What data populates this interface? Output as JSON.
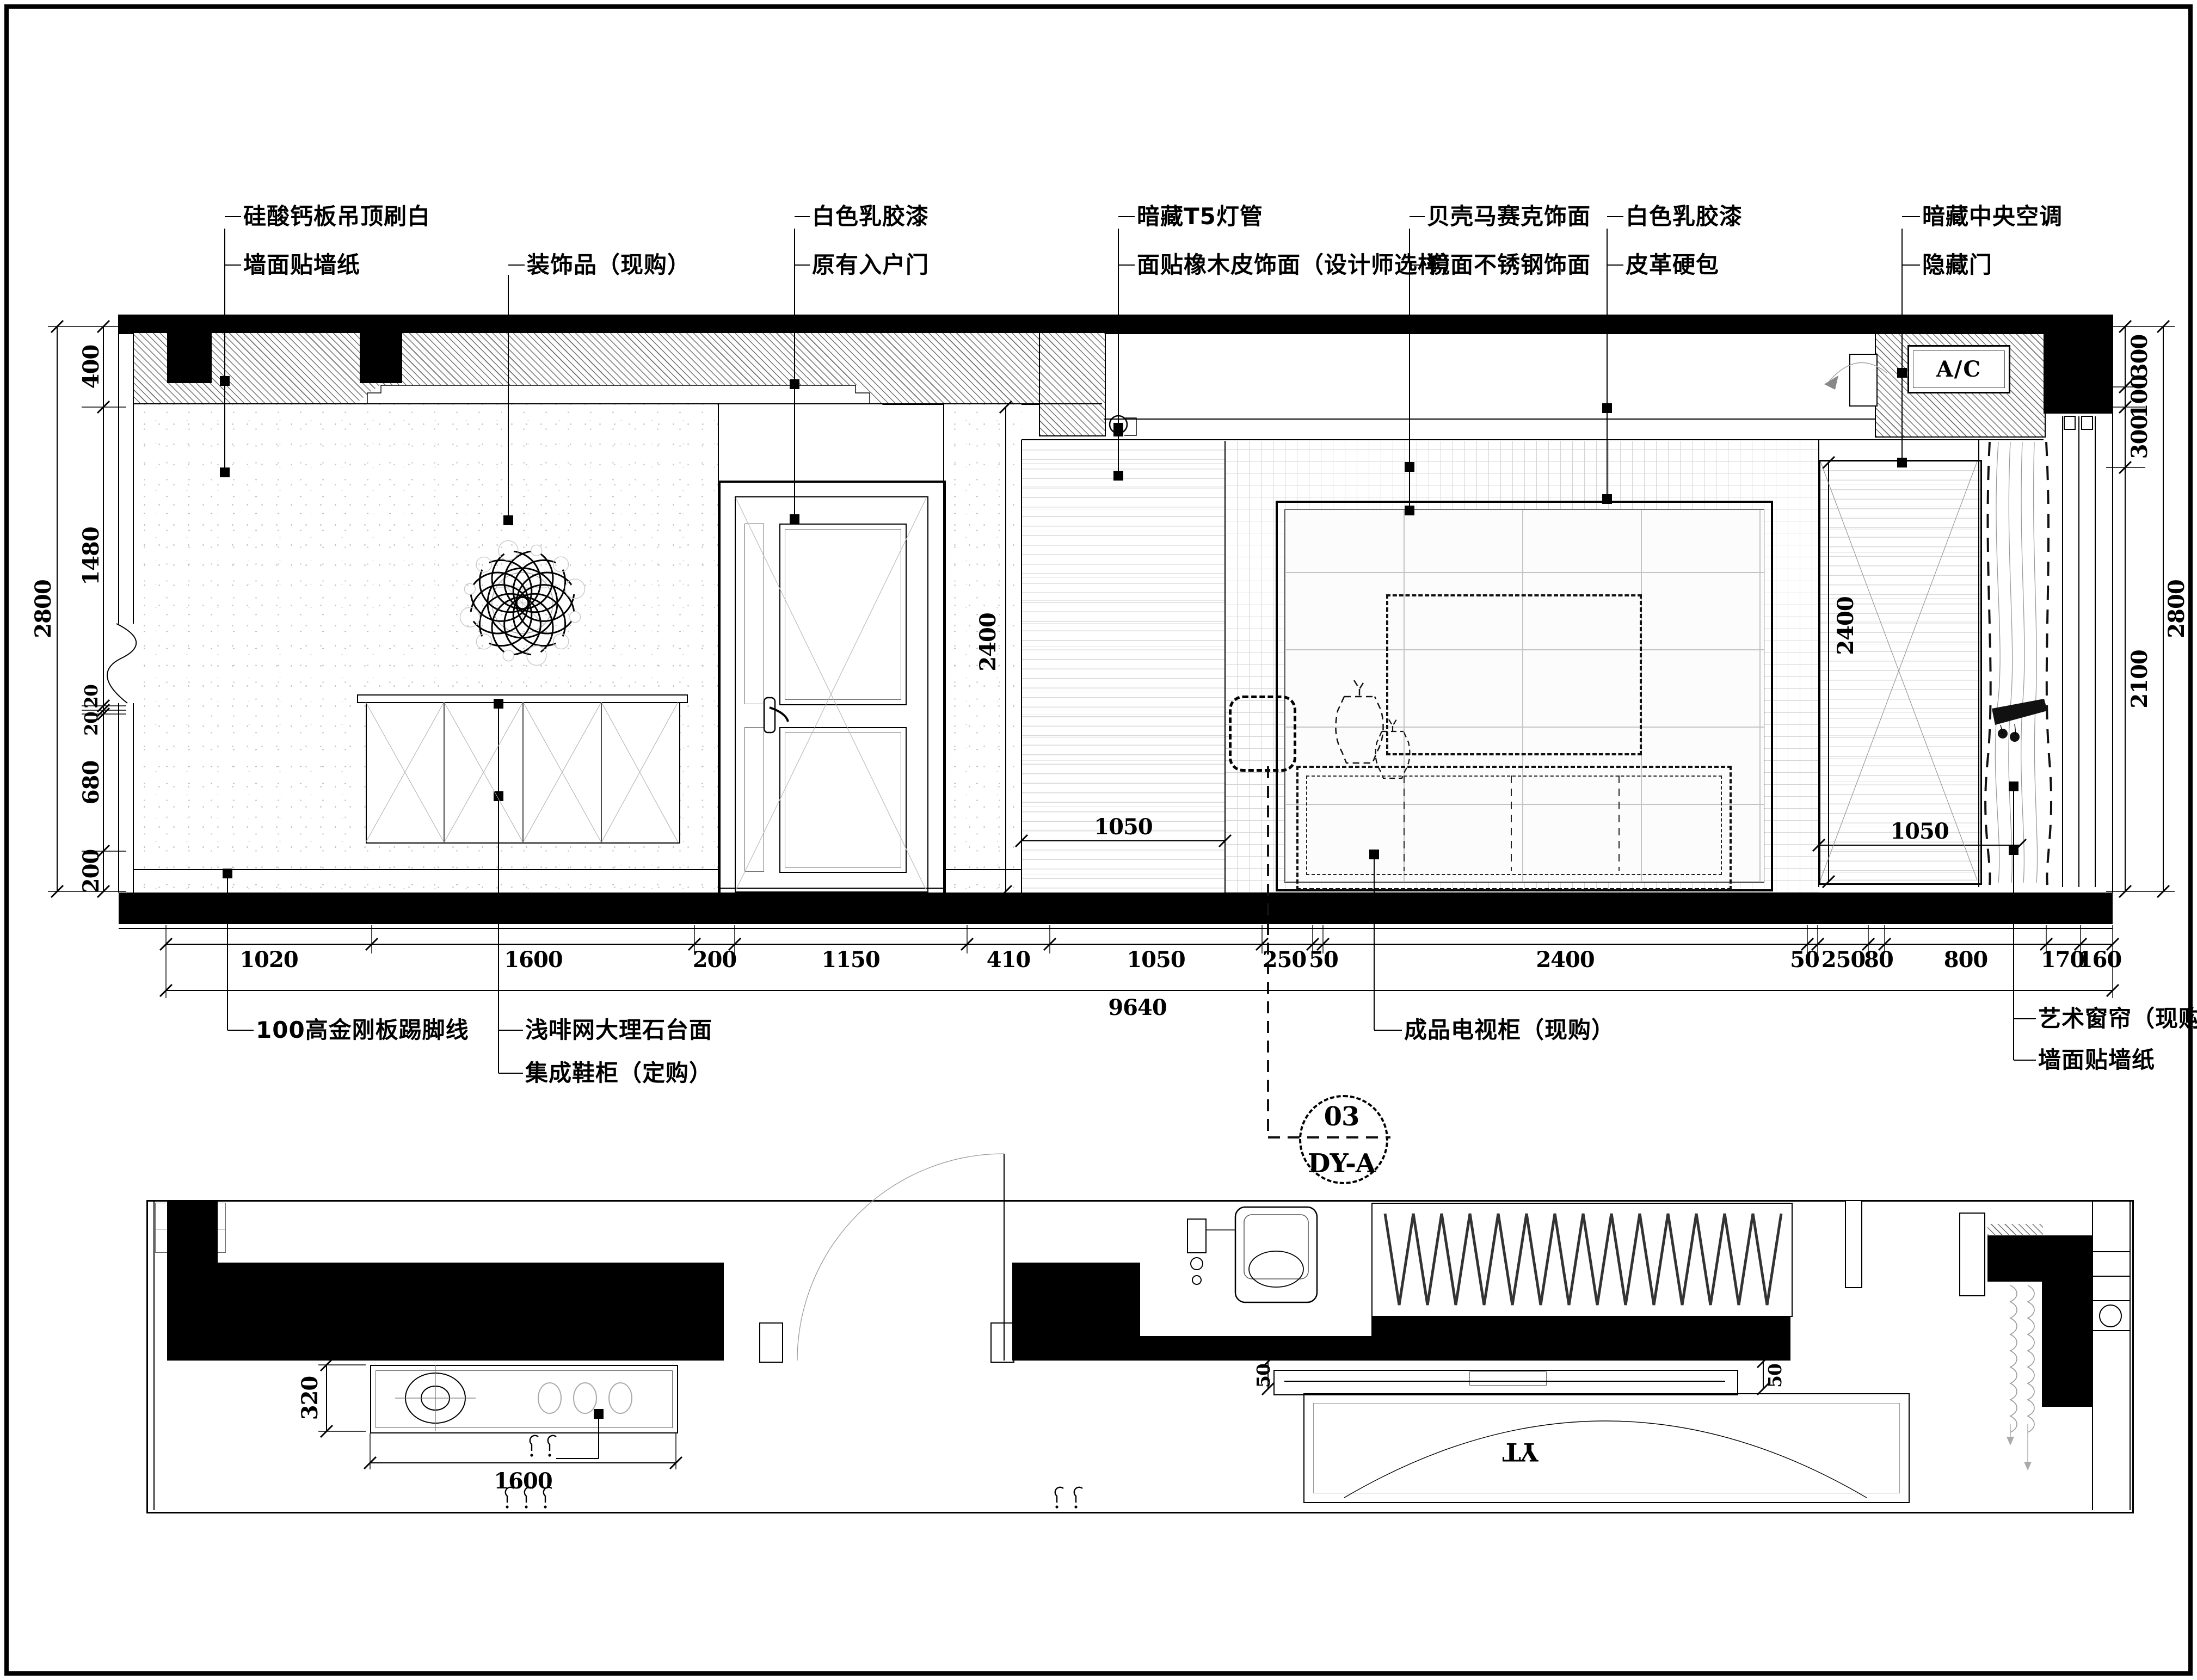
{
  "elev": {
    "top_labels": [
      "硅酸钙板吊顶刷白",
      "墙面贴墙纸",
      "装饰品（现购）",
      "白色乳胶漆",
      "原有入户门",
      "暗藏T5灯管",
      "面贴橡木皮饰面（设计师选样）",
      "贝壳马赛克饰面",
      "镜面不锈钢饰面",
      "白色乳胶漆",
      "皮革硬包",
      "暗藏中央空调",
      "隐藏门"
    ],
    "bottom_labels": [
      "100高金刚板踢脚线",
      "浅啡网大理石台面",
      "集成鞋柜（定购）",
      "成品电视柜（现购）",
      "艺术窗帘（现购）",
      "墙面贴墙纸"
    ],
    "ac_label": "A/C",
    "dims": {
      "bottom_chain": [
        "1020",
        "1600",
        "200",
        "1150",
        "410",
        "1050",
        "250",
        "50",
        "2400",
        "50",
        "250",
        "80",
        "800",
        "170",
        "160"
      ],
      "bottom_total": "9640",
      "left_chain": [
        "400",
        "1480",
        "20",
        "20",
        "680",
        "200"
      ],
      "left_total": "2800",
      "right_chain": [
        "300",
        "100",
        "300",
        "2100"
      ],
      "right_total": "2800",
      "panel_left": {
        "h": "2400",
        "w": "1050"
      },
      "panel_right": {
        "h": "2400",
        "w": "1050"
      }
    },
    "callout": {
      "number": "03",
      "code": "DY-A"
    }
  },
  "plan": {
    "dims": {
      "depth": "320",
      "width": "1600",
      "gap_left": "50",
      "gap_right": "50"
    },
    "yt_label": "YT"
  },
  "colors": {
    "line": "#000000",
    "hatch_gray": "#5a5a5a",
    "paper": "#ffffff"
  }
}
